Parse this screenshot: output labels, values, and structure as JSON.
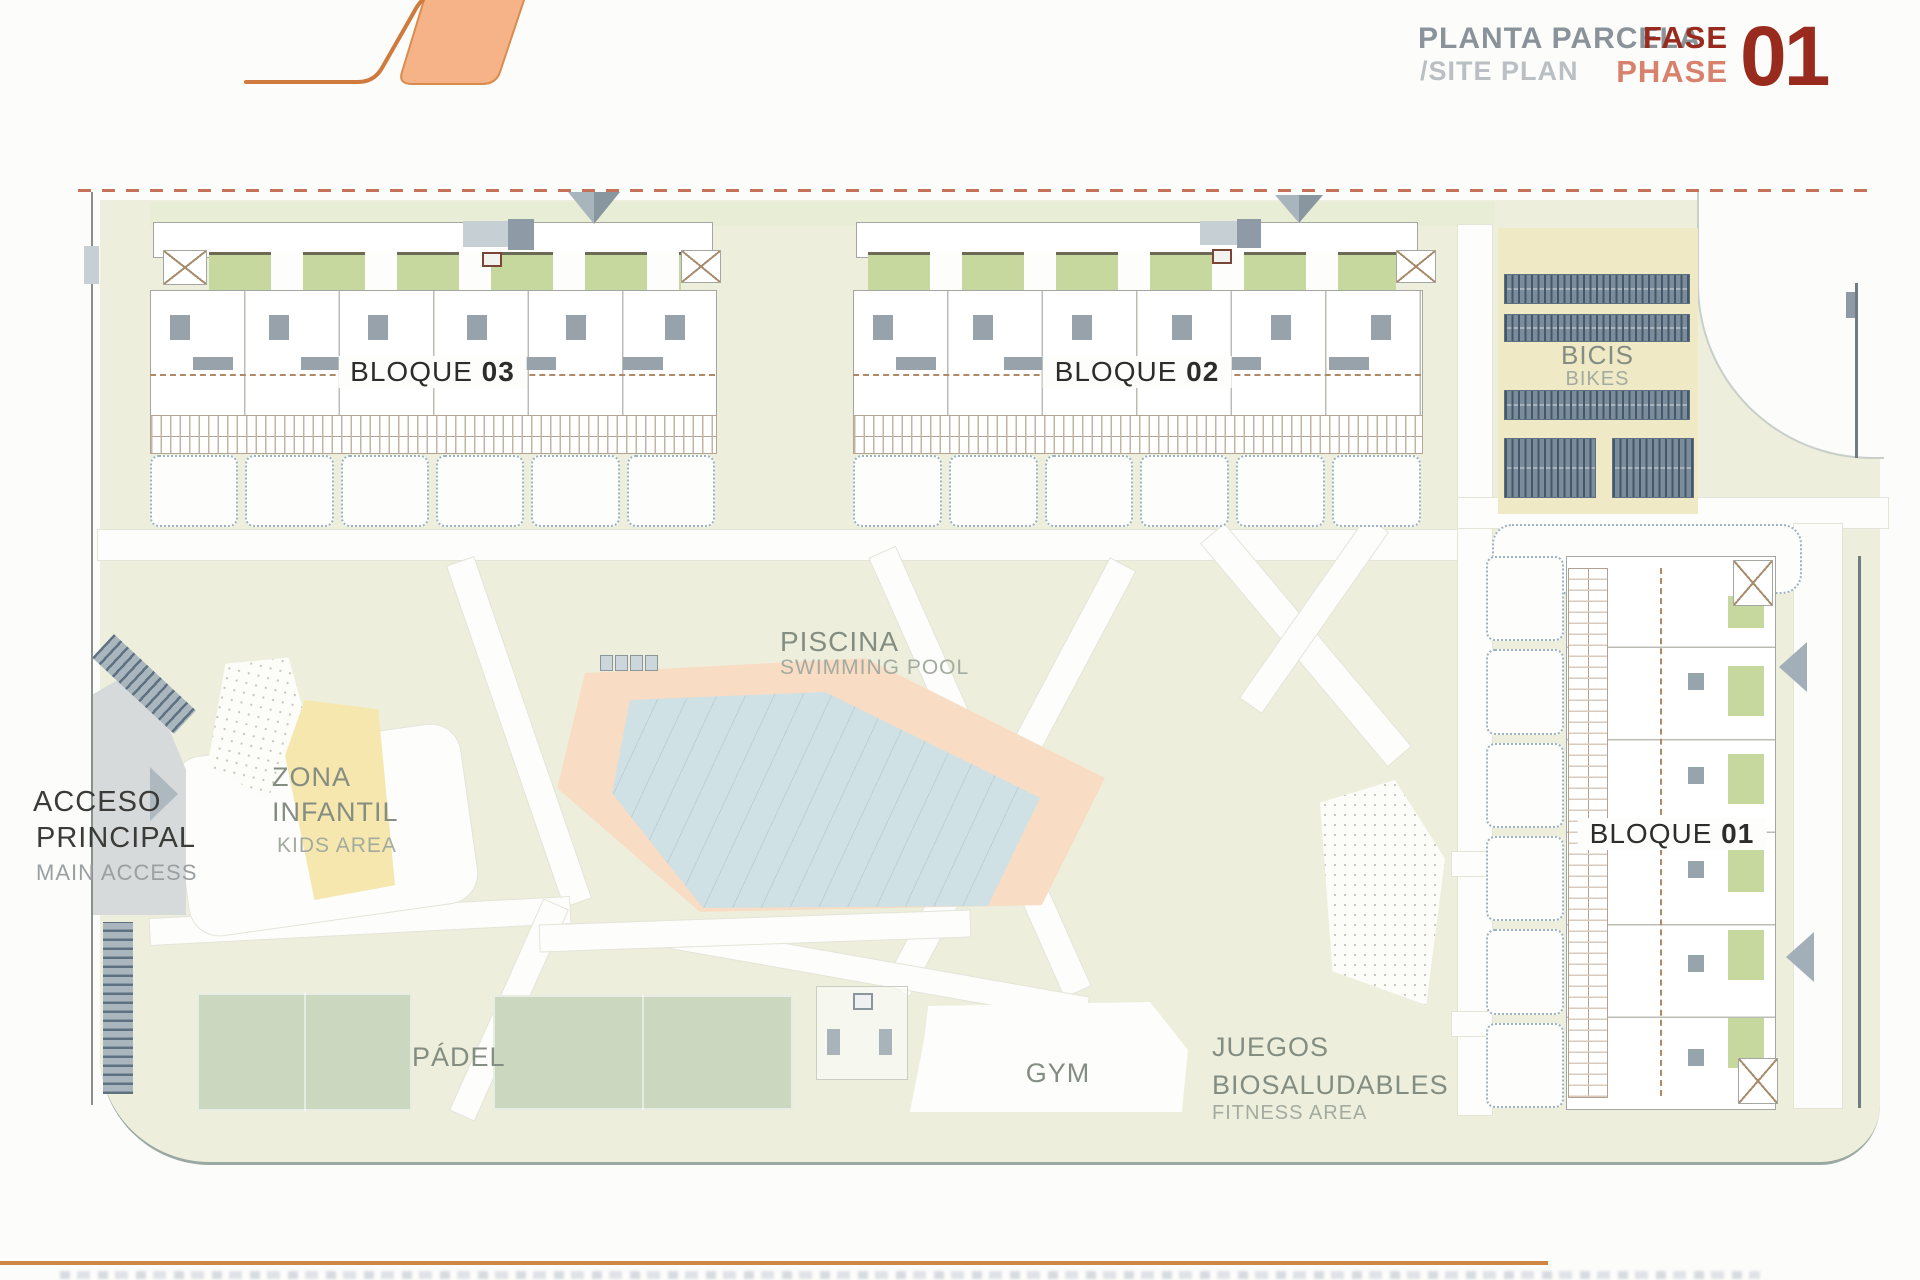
{
  "header": {
    "title_es": "PLANTA PARCELA",
    "title_en": "/SITE PLAN",
    "phase_es": "FASE",
    "phase_en": "PHASE",
    "phase_number": "01"
  },
  "blocks": {
    "b03": {
      "name": "BLOQUE",
      "num": "03"
    },
    "b02": {
      "name": "BLOQUE",
      "num": "02"
    },
    "b01": {
      "name": "BLOQUE",
      "num": "01"
    }
  },
  "labels": {
    "bikes_es": "BICIS",
    "bikes_en": "BIKES",
    "pool_es": "PISCINA",
    "pool_en": "SWIMMING POOL",
    "kids_es1": "ZONA",
    "kids_es2": "INFANTIL",
    "kids_en": "KIDS AREA",
    "access_es1": "ACCESO",
    "access_es2": "PRINCIPAL",
    "access_en": "MAIN ACCESS",
    "padel": "PÁDEL",
    "gym": "GYM",
    "fitness_es1": "JUEGOS",
    "fitness_es2": "BIOSALUDABLES",
    "fitness_en": "FITNESS AREA"
  },
  "colors": {
    "accent_orange": "#cf7a3e",
    "logo_fill": "#f6b387",
    "phase_dark_red": "#992b1e",
    "phase_salmon": "#d8826e",
    "header_gray": "#8a939a",
    "plan_green": "#edefdc",
    "beige": "#efe9c6",
    "kids_yellow": "#f6e7ae",
    "padel_green": "#cbd7bf",
    "pool_deck": "#f8dcc4",
    "pool_water": "#cfe1e4",
    "garden_green": "#c7d89e",
    "rack_blue": "#64788a",
    "boundary_dash": "#c4725a"
  }
}
